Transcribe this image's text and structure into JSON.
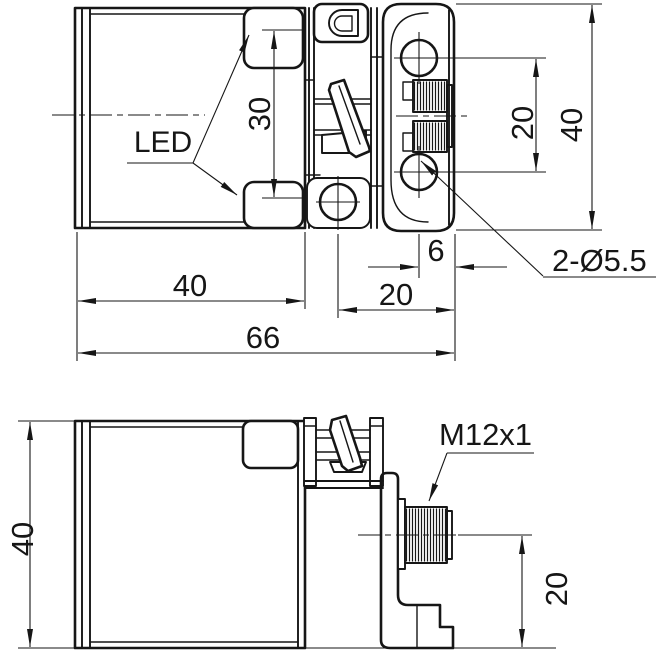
{
  "drawing": {
    "type": "technical-dimensional-drawing",
    "subject": "inductive-proximity-sensor",
    "colors": {
      "background": "#ffffff",
      "line": "#161616"
    },
    "top_view": {
      "led_label": "LED",
      "hole_callout": "2-Ø5.5",
      "dim_led_spacing": "30",
      "dim_hole_spacing": "20",
      "dim_plate_height": "40",
      "dim_hole_to_edge": "6",
      "dim_clamp_to_edge": "20",
      "dim_body_width": "40",
      "dim_overall_width": "66"
    },
    "side_view": {
      "connector_label": "M12x1",
      "dim_body_height": "40",
      "dim_connector_axis_height": "20"
    }
  }
}
